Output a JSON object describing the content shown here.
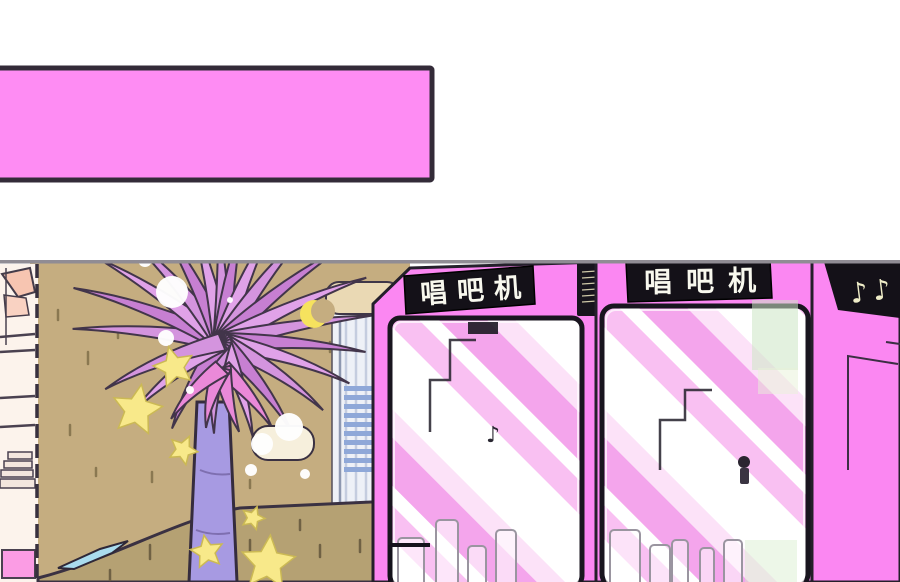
{
  "panel": {
    "type": "webtoon-comic-panel",
    "caption_box": {
      "text": "",
      "fill": "#fe8cf3",
      "border": "#332b38"
    },
    "signs": {
      "booth1": "唱吧机",
      "booth2": "唱吧机",
      "music_notes": "♪♪",
      "glass_note": "♪"
    },
    "colors": {
      "booth_pink": "#fb87f2",
      "wall_tan": "#c5ad80",
      "wall_tan_dark": "#b5a173",
      "facade_cream": "#fcf3ec",
      "awning_salmon": "#f7c5b1",
      "awning_salmon_light": "#f9d2c2",
      "bottom_pink": "#fb9ce4",
      "trunk_lavender": "#a79ae2",
      "star_yellow": "#f8e98a",
      "moon_yellow": "#f6e25e",
      "sign_black": "#141118",
      "note_cream": "#efedc8",
      "frond_palette": [
        "#d494de",
        "#c77fd2",
        "#e0a2e8"
      ],
      "frond_inner": "#ea89d8",
      "glass_stripe_pink": "#f4a5ec",
      "planter_blue": "#aadcee",
      "louver_blue": "#8fa8d8",
      "awning_beige": "#ead9b4",
      "outline_dark": "#2c2633",
      "top_rule_gray": "#908c94"
    }
  }
}
